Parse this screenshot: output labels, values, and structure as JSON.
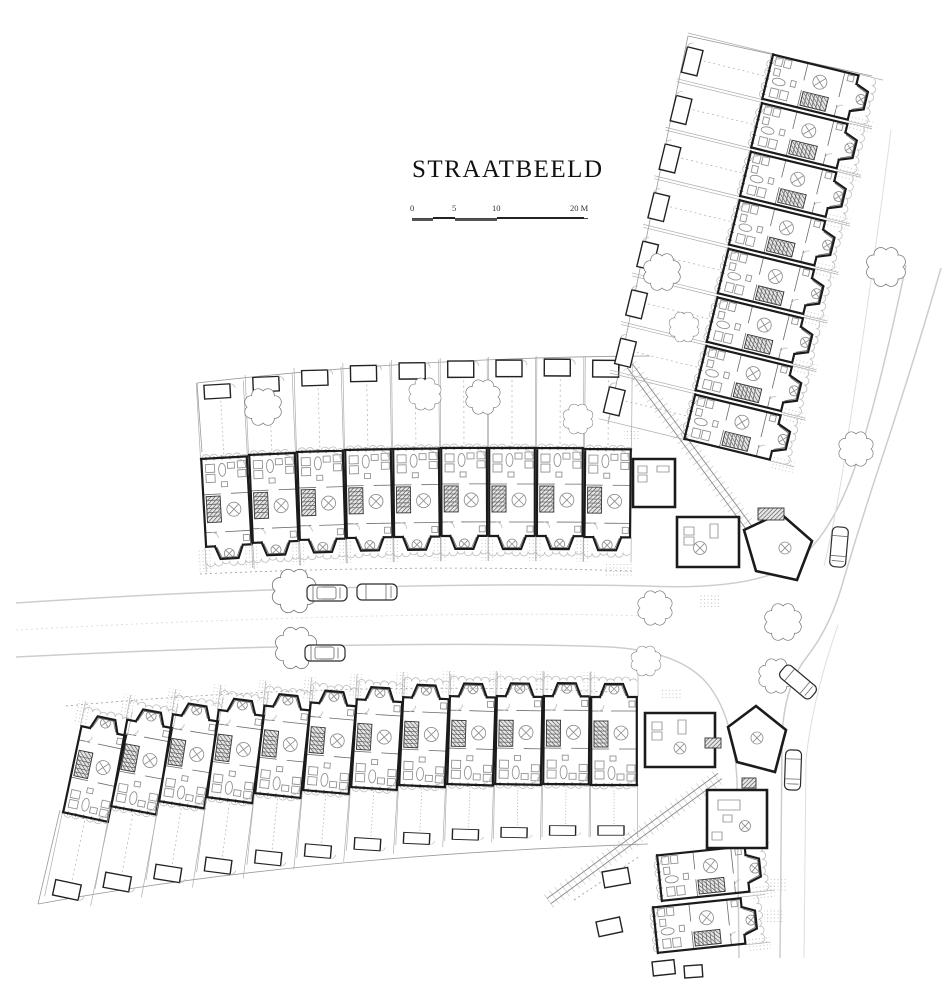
{
  "title": {
    "text": "STRAATBEELD"
  },
  "scalebar": {
    "labels": [
      "0",
      "5",
      "10",
      "20 M"
    ]
  },
  "drawing": {
    "colors": {
      "ink": "#1b1b1b",
      "medium": "#6a6a6a",
      "light": "#adadad",
      "road": "#cdcdcd",
      "background": "#ffffff"
    },
    "rows": [
      {
        "name": "middle-row",
        "flip": false,
        "garden": true,
        "units": [
          [
            200,
            459,
            -3.2,
            76
          ],
          [
            248,
            455,
            -2.4,
            80
          ],
          [
            296,
            452,
            -1.7,
            84
          ],
          [
            344,
            450,
            -1.1,
            87
          ],
          [
            392,
            449,
            -0.6,
            89
          ],
          [
            440,
            448,
            -0.2,
            90
          ],
          [
            488,
            448,
            0,
            91
          ],
          [
            536,
            448,
            0.2,
            92
          ],
          [
            584,
            449,
            0.5,
            92
          ]
        ]
      },
      {
        "name": "north-east-row",
        "flip": false,
        "garden": true,
        "units": [
          [
            762,
            100,
            -76.3,
            88
          ],
          [
            750.9,
            148.6,
            -76.3,
            88
          ],
          [
            739.8,
            197.1,
            -76.3,
            88
          ],
          [
            728.6,
            245.7,
            -76.3,
            88
          ],
          [
            717.5,
            294.3,
            -76.3,
            88
          ],
          [
            706.4,
            342.9,
            -76.3,
            88
          ],
          [
            695.3,
            391.4,
            -76.3,
            88
          ],
          [
            684.1,
            440,
            -76.3,
            88
          ]
        ]
      },
      {
        "name": "south-row",
        "flip": true,
        "garden": true,
        "units": [
          [
            62,
            812,
            12,
            86
          ],
          [
            110,
            806,
            10.5,
            84
          ],
          [
            158,
            801,
            9,
            80
          ],
          [
            206,
            797,
            7.5,
            76
          ],
          [
            254,
            793,
            6,
            72
          ],
          [
            302,
            790,
            4.8,
            68
          ],
          [
            350,
            787,
            3.6,
            64
          ],
          [
            398,
            785,
            2.6,
            60
          ],
          [
            446,
            784,
            1.8,
            57
          ],
          [
            494,
            784,
            1.1,
            55
          ],
          [
            542,
            784,
            0.5,
            53
          ],
          [
            590,
            785,
            0,
            52
          ]
        ]
      },
      {
        "name": "south-corner-houses",
        "flip": false,
        "garden": false,
        "units": [
          [
            662,
            902,
            -96,
            0
          ],
          [
            658,
            954,
            -96,
            0
          ]
        ]
      }
    ],
    "corners": {
      "walls": [
        "M633,459H675V507H633Z",
        "M677,517H739V567H677Z",
        "M744,530L780,513L812,541L797,580L756,571Z",
        "M645,713H715V767H645Z",
        "M728,727L756,706L786,730L775,772L737,762Z",
        "M707,790H767V848H707Z"
      ],
      "furniture": "M638,466h9v7h-9z M638,475h9v7h-9z M657,466h12v6h-12z M684,527h10v8h-10z M684,537h10v8h-10z M710,524h8v14h-8z M652,722h10v8h-10z M652,732h10v8h-10z M678,720h8v14h-8z M718,800h22v10h-22z M723,815h9v7h-9z M712,832h10v8h-10z",
      "tables": [
        [
          700,
          548,
          6.5
        ],
        [
          785,
          548,
          6
        ],
        [
          680,
          748,
          6
        ],
        [
          757,
          738,
          6
        ],
        [
          745,
          826,
          5.5
        ]
      ],
      "stairs": [
        [
          758,
          508,
          26,
          12
        ],
        [
          705,
          738,
          16,
          10
        ],
        [
          742,
          778,
          14,
          10
        ]
      ]
    },
    "trees": [
      [
        263,
        407,
        16
      ],
      [
        425,
        394,
        14
      ],
      [
        483,
        397,
        15
      ],
      [
        578,
        419,
        13
      ],
      [
        662,
        272,
        16
      ],
      [
        684,
        327,
        13
      ],
      [
        886,
        267,
        17
      ],
      [
        856,
        449,
        15
      ],
      [
        294,
        591,
        19
      ],
      [
        296,
        648,
        18
      ],
      [
        655,
        608,
        15
      ],
      [
        783,
        622,
        16
      ],
      [
        646,
        661,
        13
      ],
      [
        776,
        676,
        15
      ]
    ],
    "cars": [
      [
        327,
        593,
        0,
        "d"
      ],
      [
        377,
        592,
        0,
        "p"
      ],
      [
        325,
        653,
        0,
        "d"
      ],
      [
        839,
        547,
        95,
        "p"
      ],
      [
        798,
        682,
        40,
        "p"
      ],
      [
        793,
        770,
        92,
        "p"
      ]
    ],
    "roads": [
      {
        "d": "M16,603 C220,589 470,582 645,586 Q755,591 796,562 Q835,532 860,452 Q882,380 906,265",
        "c": "rd"
      },
      {
        "d": "M941,268 Q912,368 878,470 Q857,534 843,582 Q830,628 806,658 Q782,690 782,745 L780,958",
        "c": "rd"
      },
      {
        "d": "M16,657 C230,646 460,641 610,647 Q676,651 704,680 Q733,711 737,780 L739,958",
        "c": "rd"
      },
      {
        "d": "M16,630 C250,617 500,611 648,616",
        "c": "rd2 dash"
      },
      {
        "d": "M891,130 Q868,310 848,435 Q838,508 824,566",
        "c": "rd2"
      },
      {
        "d": "M838,625 Q812,700 806,760 L804,958",
        "c": "rd2"
      }
    ],
    "fences": [
      {
        "d": "M197,383 Q420,357 650,356"
      },
      {
        "d": "M197,383 L202,452"
      },
      {
        "d": "M38,904 Q300,856 648,844"
      },
      {
        "d": "M38,904 L60,810"
      },
      {
        "d": "M688,36 L608,424"
      },
      {
        "d": "M688,36 L872,76"
      },
      {
        "d": "M200,574 Q420,564 634,571",
        "dash": true
      },
      {
        "d": "M66,706 Q350,680 610,692",
        "dash": true
      },
      {
        "d": "M574,900 L640,856",
        "dash": true
      }
    ],
    "alleys": [
      [
        630,
        366,
        750,
        529
      ],
      [
        549,
        901,
        720,
        776
      ]
    ],
    "stipples": [
      [
        604,
        562,
        28,
        15
      ],
      [
        698,
        594,
        22,
        13
      ],
      [
        660,
        688,
        22,
        12
      ],
      [
        768,
        878,
        20,
        14
      ],
      [
        764,
        908,
        20,
        14
      ],
      [
        624,
        430,
        16,
        10
      ]
    ],
    "sheds": [
      [
        602,
        872,
        26,
        16,
        -10
      ],
      [
        596,
        922,
        24,
        15,
        -12
      ],
      [
        652,
        962,
        22,
        14,
        -6
      ],
      [
        684,
        966,
        18,
        12,
        -4
      ]
    ]
  }
}
